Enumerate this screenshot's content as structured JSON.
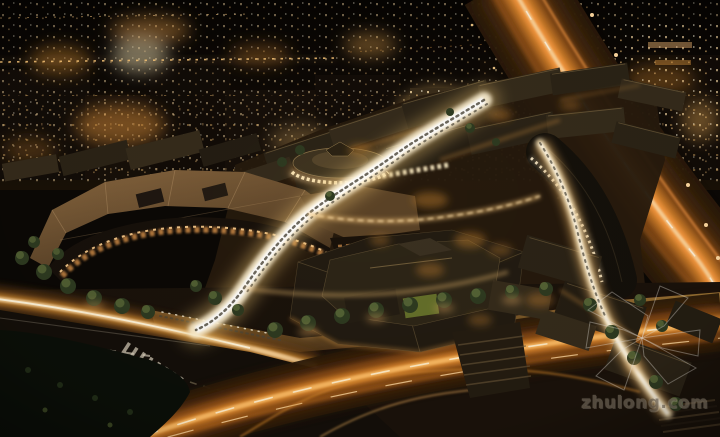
{
  "watermark": {
    "text": "zhulong.com",
    "logo_icon": "pavilion-wireframe-icon"
  },
  "palette": {
    "night_sky": "#0b0805",
    "city_glow": "#d9953f",
    "window_warm": "#ffdfa8",
    "street_light": "#fff3d6",
    "trail_orange": "#ff9d42",
    "trail_deep": "#a65f1d",
    "roof_dark": "#241d12",
    "roof_tan": "#8a6840",
    "tree_green": "#2e3a20",
    "road_dark": "#14100a",
    "lane_marking": "#ded4c0",
    "watermark_gray": "#6a6052"
  }
}
